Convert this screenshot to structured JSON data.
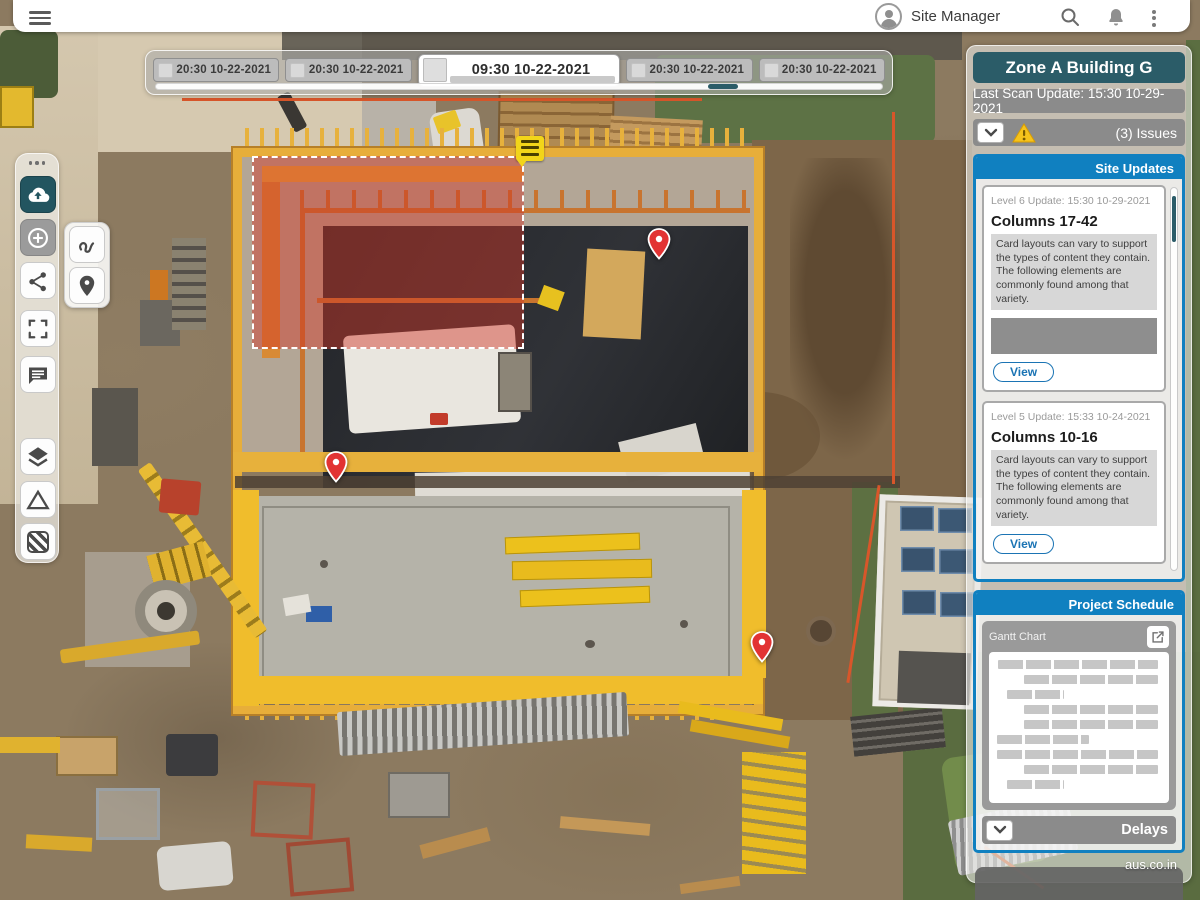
{
  "topbar": {
    "user_label": "Site Manager"
  },
  "timeline": {
    "items": [
      {
        "label": "20:30 10-22-2021",
        "selected": false
      },
      {
        "label": "20:30 10-22-2021",
        "selected": false
      },
      {
        "label": "09:30 10-22-2021",
        "selected": true
      },
      {
        "label": "20:30 10-22-2021",
        "selected": false
      },
      {
        "label": "20:30 10-22-2021",
        "selected": false
      }
    ]
  },
  "toolbar": {
    "tools": [
      "upload-cloud",
      "add-annotation",
      "share",
      "fullscreen",
      "comment",
      "layers",
      "measure-triangle",
      "hatch-fill"
    ],
    "flyout_tools": [
      "draw-freehand",
      "drop-pin"
    ]
  },
  "map": {
    "pin_count": 3,
    "has_selection_region": true,
    "note_marker": "yellow-note"
  },
  "sidebar": {
    "title": "Zone A Building G",
    "last_scan": "Last Scan Update: 15:30 10-29-2021",
    "issues_label": "(3) Issues",
    "site_updates": {
      "header": "Site Updates",
      "cards": [
        {
          "meta": "Level 6 Update: 15:30 10-29-2021",
          "title": "Columns 17-42",
          "body": "Card layouts can vary to support the types of content they contain. The following elements are commonly found among that variety.",
          "action": "View"
        },
        {
          "meta": "Level 5 Update: 15:33 10-24-2021",
          "title": "Columns 10-16",
          "body": "Card layouts can vary to support the types of content they contain. The following elements are commonly found among that variety.",
          "action": "View"
        }
      ]
    },
    "schedule": {
      "header": "Project Schedule",
      "gantt_label": "Gantt Chart",
      "gantt_rows": [
        {
          "start": 2,
          "width": 95
        },
        {
          "start": 17,
          "width": 80
        },
        {
          "start": 7,
          "width": 34
        },
        {
          "start": 17,
          "width": 80
        },
        {
          "start": 17,
          "width": 80
        },
        {
          "start": 1,
          "width": 55
        },
        {
          "start": 1,
          "width": 96
        },
        {
          "start": 17,
          "width": 80
        },
        {
          "start": 7,
          "width": 34
        }
      ],
      "delays_label": "Delays"
    },
    "footer": "aus.co.in"
  },
  "colors": {
    "accent_teal": "#2b5c68",
    "accent_blue": "#1080c0",
    "bar_gray": "#8b8b8b",
    "warning_yellow": "#f6c31c",
    "pin_red": "#e23333",
    "highlight_red_fill": "rgba(210,55,40,0.46)",
    "formwork_yellow": "#e7b13c"
  }
}
